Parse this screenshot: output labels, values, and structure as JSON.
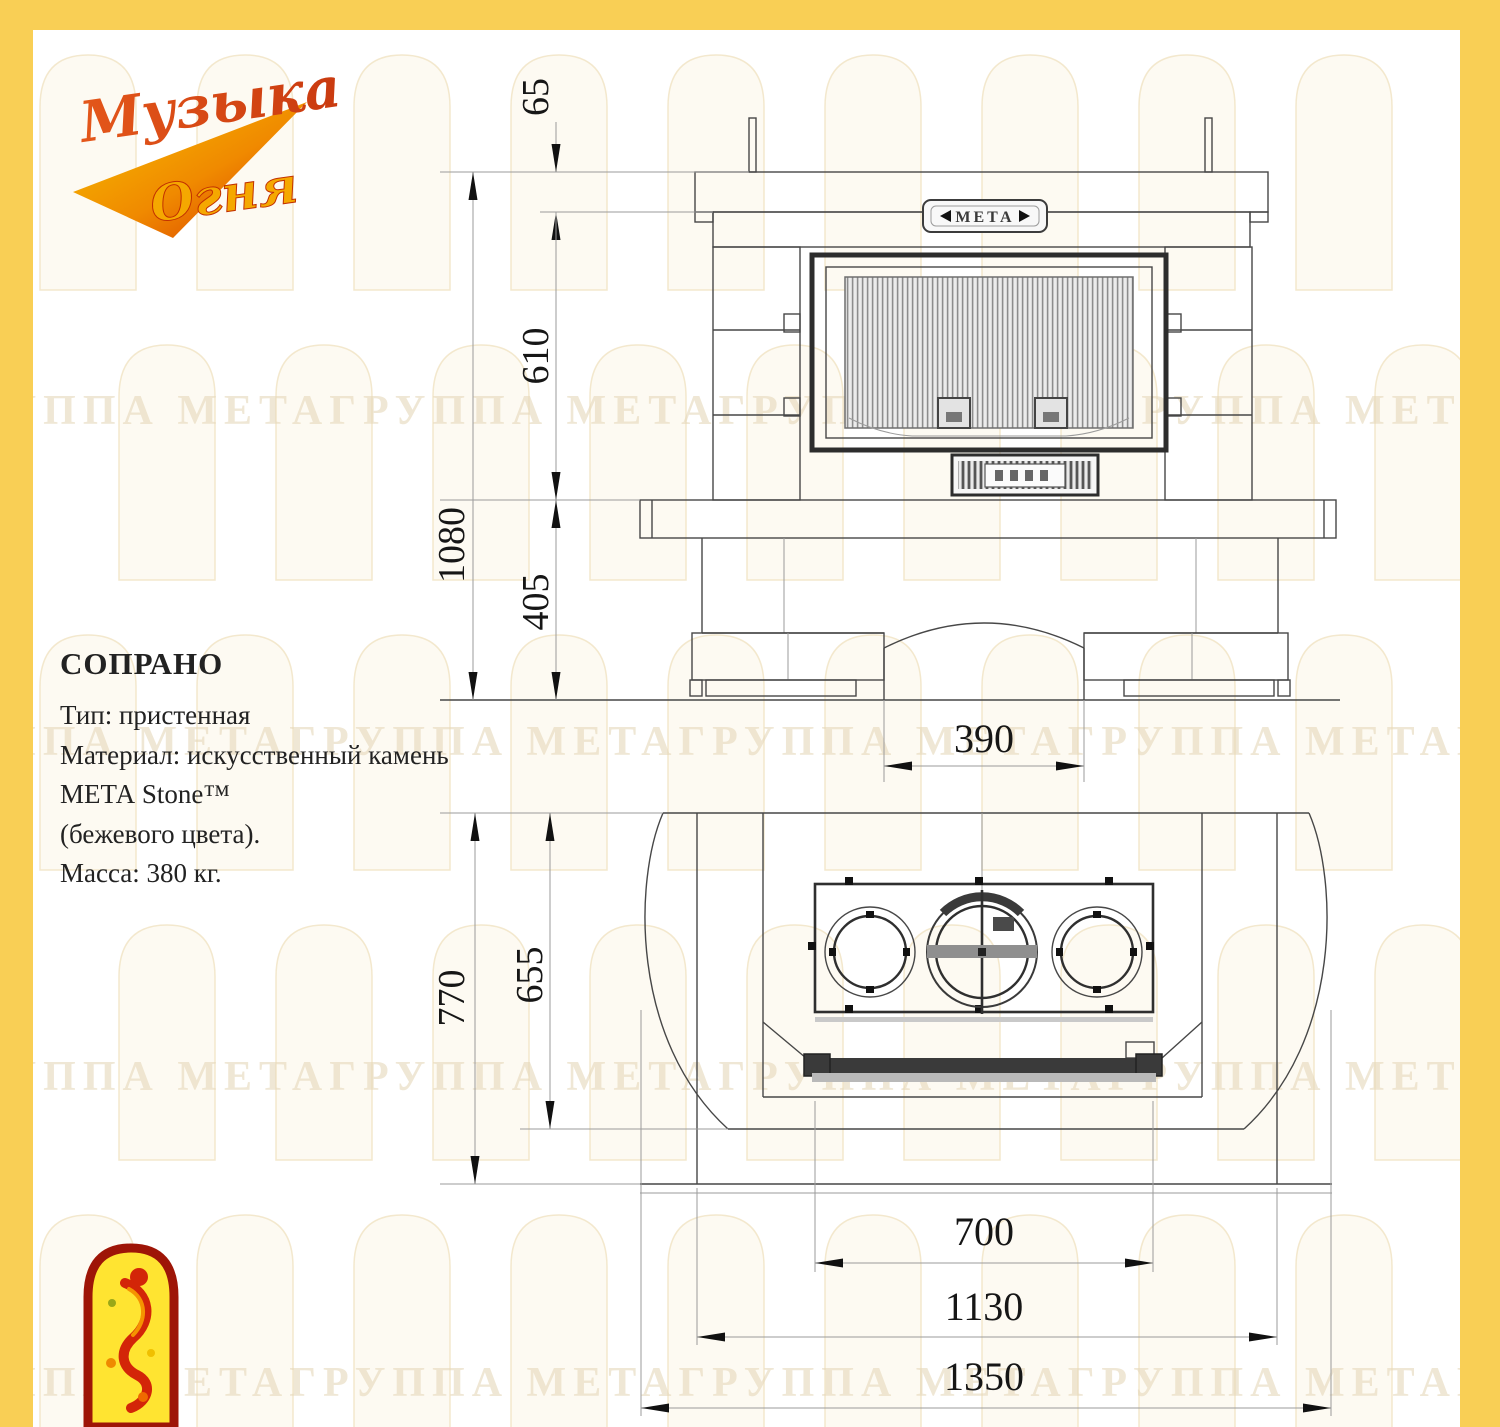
{
  "brand": {
    "logo_line1": "Музыка",
    "logo_line2": "Огня"
  },
  "specs": {
    "model": "СОПРАНО",
    "line_type": "Тип: пристенная",
    "line_material": "Материал: искусственный камень",
    "line_material2": "МЕТА Stone™",
    "line_material3": "(бежевого  цвета).",
    "line_mass": "Масса: 380 кг."
  },
  "front_view": {
    "nameplate": "МЕТА",
    "dims": {
      "mantel_thickness": "65",
      "firebox_height": "610",
      "total_height": "1080",
      "base_height": "405",
      "niche_width": "390"
    }
  },
  "plan_view": {
    "dims": {
      "depth_total": "770",
      "depth_inner": "655",
      "insert_width": "700",
      "body_width": "1130",
      "total_width": "1350"
    }
  },
  "watermark": {
    "text": "ГРУППА МЕТАГРУППА МЕТАГРУППА МЕТАГРУППА МЕТАГРУППА МЕТА"
  },
  "colors": {
    "frame_yellow": "#f9cf55",
    "logo_red": "#9e1507",
    "logo_yellow": "#ffe431",
    "line_dark": "#474747"
  }
}
